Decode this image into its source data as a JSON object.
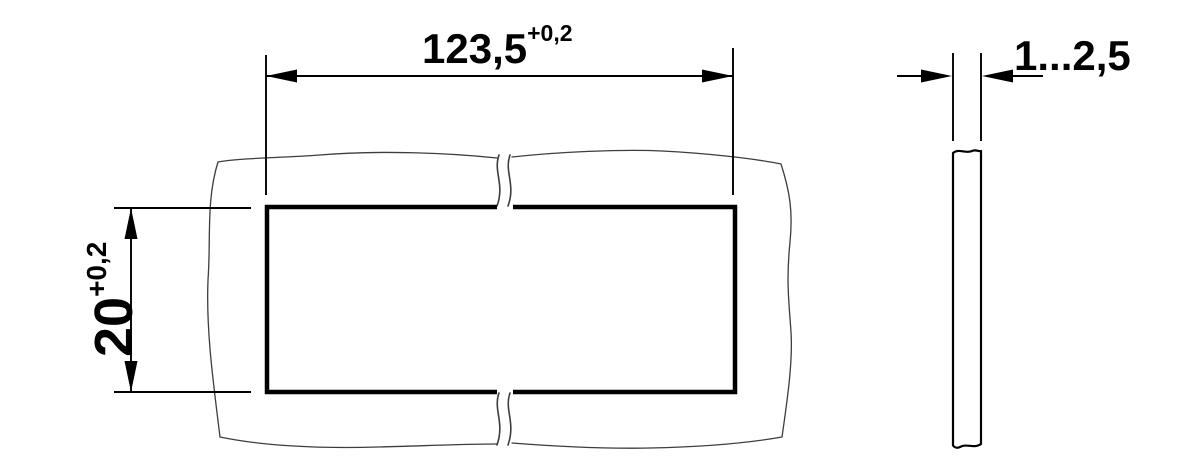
{
  "page": {
    "background_color": "#ffffff",
    "ink_color": "#000000",
    "contour_color": "#3d3d3d"
  },
  "drawing": {
    "front_view": {
      "width_dimension": {
        "value": "123,5",
        "tolerance": "+0,2"
      },
      "height_dimension": {
        "value": "20",
        "tolerance": "+0,2"
      }
    },
    "side_view": {
      "thickness_dimension": {
        "value": "1...2,5"
      }
    }
  }
}
